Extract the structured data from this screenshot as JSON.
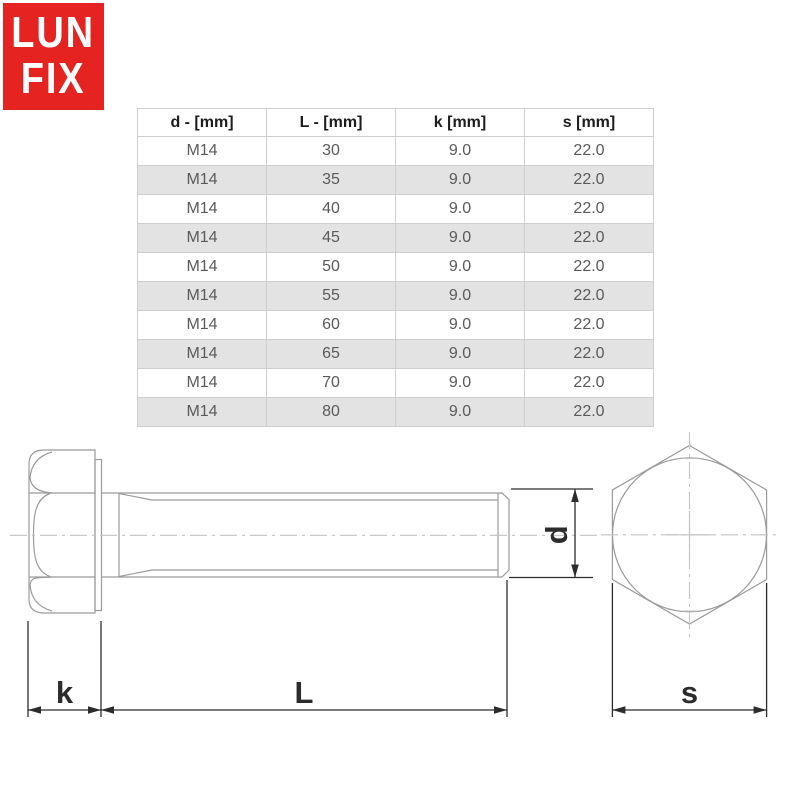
{
  "logo": {
    "line1": "LUN",
    "line2": "FIX",
    "bg_color": "#e52421",
    "text_color": "#ffffff"
  },
  "table": {
    "headers": [
      "d - [mm]",
      "L - [mm]",
      "k [mm]",
      "s [mm]"
    ],
    "rows": [
      [
        "M14",
        "30",
        "9.0",
        "22.0"
      ],
      [
        "M14",
        "35",
        "9.0",
        "22.0"
      ],
      [
        "M14",
        "40",
        "9.0",
        "22.0"
      ],
      [
        "M14",
        "45",
        "9.0",
        "22.0"
      ],
      [
        "M14",
        "50",
        "9.0",
        "22.0"
      ],
      [
        "M14",
        "55",
        "9.0",
        "22.0"
      ],
      [
        "M14",
        "60",
        "9.0",
        "22.0"
      ],
      [
        "M14",
        "65",
        "9.0",
        "22.0"
      ],
      [
        "M14",
        "70",
        "9.0",
        "22.0"
      ],
      [
        "M14",
        "80",
        "9.0",
        "22.0"
      ]
    ],
    "alt_row_bg": "#e3e3e3",
    "border_color": "#cfcfcf",
    "header_text_color": "#1d1d1d",
    "cell_text_color": "#5a5a5a"
  },
  "drawing": {
    "labels": {
      "k": "k",
      "L": "L",
      "d": "d",
      "s": "s"
    },
    "outline_color": "#9b9b9b",
    "centerline_color": "#c3c3c3",
    "dimension_color": "#2c2c2c"
  }
}
